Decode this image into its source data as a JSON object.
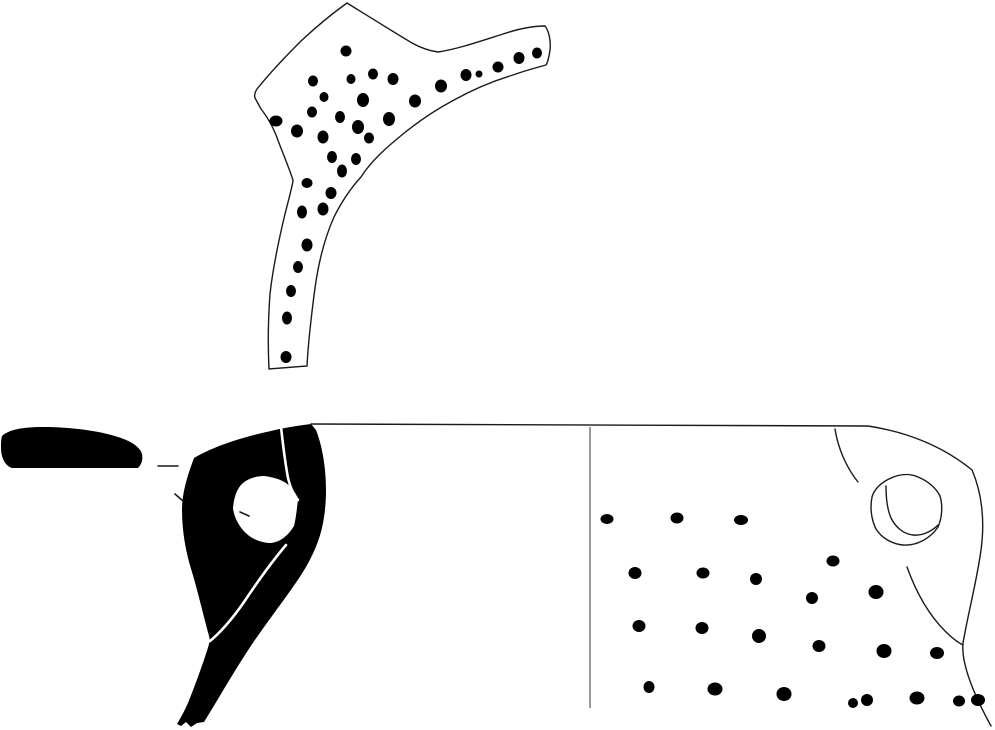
{
  "canvas": {
    "width": 995,
    "height": 730,
    "background": "#ffffff"
  },
  "colors": {
    "ink": "#000000",
    "outline": "#1a1a1a",
    "guide_line": "#9a9a9a",
    "background": "#ffffff"
  },
  "top_sherd": {
    "outline_path": "M 347,3 C 368,16 392,31 412,43 C 421,48 431,51 438,52 C 458,49 481,41 503,34 C 518,29 533,26 545,26 C 549,31 551,41 550,50 C 549,57 548,62 546,65 C 535,68 524,71 513,75 C 493,81 472,90 454,100 C 437,109 419,121 403,134 C 387,147 371,161 361,177 C 350,189 341,203 334,217 C 326,235 319,259 315,288 C 311,318 308,346 307,366 L 269,369 C 268,349 268,321 270,294 C 273,267 279,239 285,214 C 290,194 293,184 293,180 C 289,168 284,156 279,143 C 275,131 269,119 261,109 L 255,98 C 254,95 255,92 257,89 C 269,74 284,58 301,41 C 316,27 333,13 347,3 Z",
    "dots": [
      [
        346,
        51,
        5.5,
        5.5
      ],
      [
        313,
        81,
        5,
        5.5
      ],
      [
        351,
        79,
        4.5,
        5
      ],
      [
        373,
        74,
        5,
        5.5
      ],
      [
        393,
        79,
        5.5,
        6
      ],
      [
        441,
        86,
        6,
        6.5
      ],
      [
        466,
        75,
        5.5,
        6
      ],
      [
        479,
        74,
        3.5,
        3.5
      ],
      [
        498,
        67,
        5.5,
        5.5
      ],
      [
        519,
        58,
        5.5,
        6
      ],
      [
        537,
        53,
        5,
        5.5
      ],
      [
        324,
        97,
        4.5,
        5
      ],
      [
        363,
        100,
        6,
        7
      ],
      [
        415,
        101,
        6,
        6.5
      ],
      [
        312,
        112,
        5,
        5.5
      ],
      [
        276,
        121,
        6.5,
        5.5
      ],
      [
        297,
        131,
        6,
        6.5
      ],
      [
        340,
        117,
        5,
        6
      ],
      [
        358,
        127,
        6,
        7
      ],
      [
        389,
        119,
        6,
        7
      ],
      [
        323,
        137,
        5.5,
        6.5
      ],
      [
        369,
        138,
        5,
        5.5
      ],
      [
        332,
        157,
        5,
        6
      ],
      [
        356,
        159,
        5,
        6
      ],
      [
        342,
        171,
        5,
        6.5
      ],
      [
        307,
        183,
        5.5,
        5
      ],
      [
        331,
        193,
        5.5,
        6
      ],
      [
        302,
        212,
        5,
        6.5
      ],
      [
        323,
        209,
        5.5,
        6.5
      ],
      [
        307,
        245,
        5.5,
        6.5
      ],
      [
        298,
        267,
        5,
        6
      ],
      [
        291,
        291,
        5,
        6
      ],
      [
        287,
        318,
        5,
        6.5
      ],
      [
        286,
        357,
        5.5,
        6
      ]
    ]
  },
  "profile_section": {
    "rim_bar_path": "M 2,436 C 8,430 22,427 42,427 C 72,427 100,431 118,437 C 131,441 140,447 142,454 C 143,459 142,464 138,468 L 12,468 C 5,466 1,457 1,448 C 1,444 1,439 2,436 Z",
    "body_path": "M 311,424 C 296,426 283,428 271,431 C 242,437 212,447 194,458 C 187,477 182,493 182,510 C 182,532 186,553 192,572 C 198,592 203,614 209,636 L 210,641 C 204,661 196,683 188,703 C 184,712 180,719 177,724 L 181,726 L 186,722 L 191,727 L 197,723 L 204,722 C 209,714 215,704 221,694 C 233,674 245,654 257,637 C 271,617 284,600 295,584 C 305,570 312,557 317,544 C 323,529 326,510 326,490 C 326,467 322,445 316,430 Z",
    "aperture_path": "M 233,508 C 234,497 237,488 243,483 C 249,478 257,476 264,476 C 272,477 280,479 286,483 C 292,488 296,493 298,499 C 297,508 296,518 294,526 C 288,536 280,542 271,543 C 262,543 252,539 247,534 C 240,528 234,518 233,508 Z",
    "inner_edge_line": "M 281,427 C 283,445 285,462 288,478 C 290,487 293,494 298,500",
    "lower_edge_line": "M 286,545 C 275,558 258,581 244,602 C 233,618 220,633 210,641",
    "dashes": [
      "M 158,466 L 178,466",
      "M 175,494 L 183,501",
      "M 240,512 L 249,516"
    ]
  },
  "exterior_view": {
    "rim_and_edge_path": "M 311,424 L 868,426 C 908,432 944,447 972,470 C 982,493 985,521 981,550 C 977,580 968,614 963,643 C 961,663 973,693 991,726",
    "center_line_path": "M 590,427 L 590,708",
    "handle": {
      "upper_arc": "M 835,429 C 838,448 846,467 858,482",
      "stub_outer": "M 872,497 C 874,490 880,484 887,480 C 898,474 909,473 918,477 C 928,481 936,488 940,496 C 943,506 942,518 938,527 C 930,539 916,546 903,545 C 891,544 881,537 876,529 C 871,519 870,507 872,497 Z",
      "stub_inner": "M 886,486 C 886,497 887,509 891,518 C 896,528 904,534 913,535 C 923,536 932,531 938,525",
      "lower_curve": "M 907,567 C 916,592 929,615 945,631 C 951,637 957,642 963,645"
    },
    "dots": [
      [
        607,
        519,
        6.5,
        5
      ],
      [
        677,
        518,
        6.5,
        5.5
      ],
      [
        741,
        520,
        7,
        5
      ],
      [
        635,
        573,
        6.5,
        6
      ],
      [
        703,
        573,
        6.5,
        5.5
      ],
      [
        756,
        579,
        6,
        6
      ],
      [
        833,
        561,
        6.5,
        5.5
      ],
      [
        812,
        598,
        6,
        6
      ],
      [
        876,
        592,
        7.5,
        7
      ],
      [
        639,
        626,
        6.5,
        6
      ],
      [
        702,
        628,
        6.5,
        6
      ],
      [
        759,
        636,
        7,
        7
      ],
      [
        819,
        646,
        6.5,
        6
      ],
      [
        884,
        651,
        7.5,
        7
      ],
      [
        937,
        653,
        7,
        6
      ],
      [
        649,
        687,
        5.5,
        6
      ],
      [
        715,
        689,
        7.5,
        6.5
      ],
      [
        784,
        694,
        7.5,
        7
      ],
      [
        853,
        703,
        5,
        5
      ],
      [
        867,
        700,
        6,
        6
      ],
      [
        917,
        698,
        7.5,
        6.5
      ],
      [
        959,
        701,
        6,
        5.5
      ],
      [
        978,
        700,
        7,
        6
      ]
    ]
  }
}
